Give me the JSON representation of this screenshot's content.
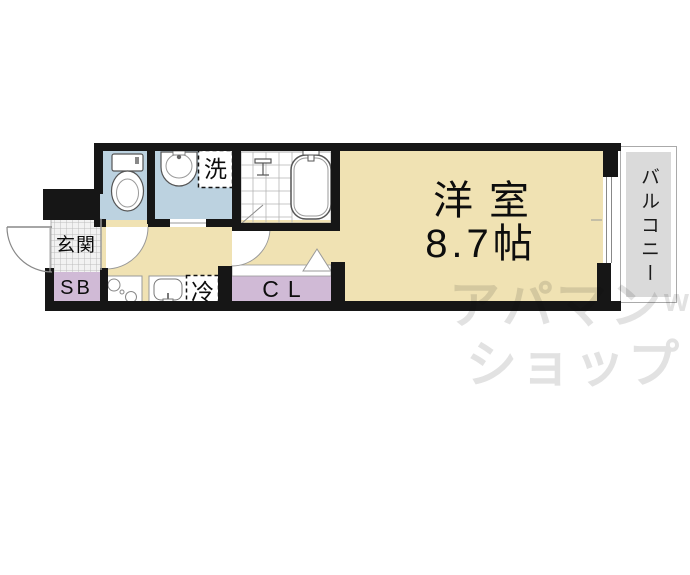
{
  "floorplan": {
    "main_room": {
      "name": "洋室",
      "size": "8.7帖"
    },
    "balcony_label": "バルコニー",
    "entrance_label": "玄関",
    "shoe_box_label": "SB",
    "closet_label": "CL",
    "washing_machine_label": "洗",
    "refrigerator_label": "冷",
    "colors": {
      "room_beige": "#F0E2B3",
      "water_blue": "#BCD2E0",
      "closet_purple": "#D0BAD6",
      "balcony_gray": "#DADADA",
      "wall_black": "#161616",
      "watermark_gray": "#E2E2E2"
    }
  },
  "watermark": {
    "line1": "アパマン",
    "suffix": "w",
    "line2": "ショップ"
  }
}
